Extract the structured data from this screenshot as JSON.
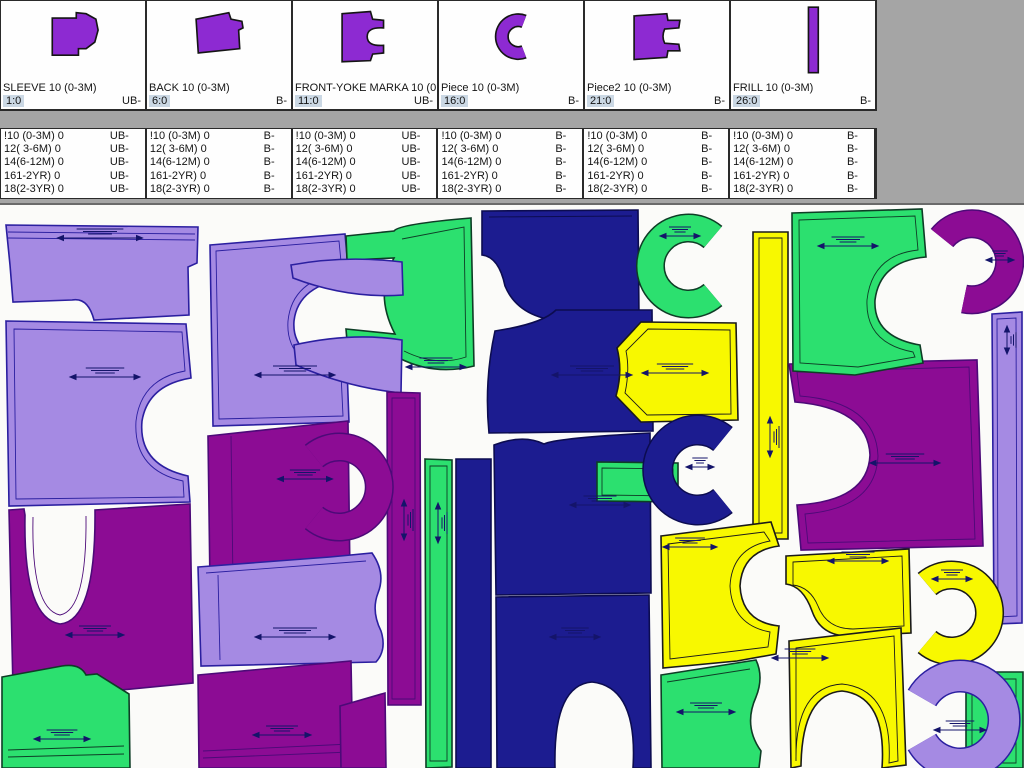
{
  "palette": {
    "lavender": [
      "#a58ae3",
      "#2b1fa0"
    ],
    "purple": [
      "#8c0c94",
      "#4c0a78"
    ],
    "navy": [
      "#1c1c90",
      "#0c0c50"
    ],
    "green": [
      "#2ce06f",
      "#0e3d26"
    ],
    "yellow": [
      "#f8f800",
      "#1a1a1a"
    ],
    "thumb": [
      "#8d2ad2",
      "#151515"
    ],
    "chip_bg": "#cbd8e4",
    "window_bg": "#a5a5a5",
    "marker_bg": "#fbfbf9",
    "annotation": "#14146a"
  },
  "cards": [
    {
      "name": "SLEEVE 10 (0-3M)",
      "index": "1:0",
      "suffix": "UB-",
      "thumb": {
        "d": "M16,12 L38,12 L38,7 L47,8 L56,13 L58,23 L55,34 L47,40 L40,40 L40,46 L16,46 Z"
      }
    },
    {
      "name": "BACK 10 (0-3M)",
      "index": "6:0",
      "suffix": "B-",
      "thumb": {
        "d": "M14,13 L44,7 L46,13 L56,15 L57,21 L53,23 L54,40 L16,44 Z"
      }
    },
    {
      "name": "FRONT-YOKE MARKA 10 (0-3M)",
      "index": "11:0",
      "suffix": "UB-",
      "thumb": {
        "d": "M14,8 L40,6 L42,13 L52,14 L52,21 Q37,20 37,29 Q37,38 52,37 L52,44 L42,45 L40,51 L14,52 Z"
      }
    },
    {
      "name": "Piece 10 (0-3M)",
      "index": "16:0",
      "suffix": "B-",
      "thumb": {
        "type": "arc",
        "d": "M47,15 A15,15 0 1 0 47,43",
        "w": 10
      }
    },
    {
      "name": "Piece2 10 (0-3M)",
      "index": "21:0",
      "suffix": "B-",
      "thumb": {
        "d": "M14,10 L44,8 L45,14 L56,14 L55,21 L42,22 Q39,29 42,35 L55,36 L56,42 L45,42 L44,48 L14,50 Z"
      }
    },
    {
      "name": "FRILL 10 (0-3M)",
      "index": "26:0",
      "suffix": "B-",
      "thumb": {
        "d": "M40,2 L49,2 L49,62 L40,62 Z"
      }
    }
  ],
  "size_lists": [
    {
      "suffix": "UB-",
      "rows": [
        "!10 (0-3M) 0",
        "12( 3-6M) 0",
        "14(6-12M) 0",
        "161-2YR) 0",
        "18(2-3YR) 0"
      ]
    },
    {
      "suffix": "B-",
      "rows": [
        "!10 (0-3M) 0",
        "12( 3-6M) 0",
        "14(6-12M) 0",
        "161-2YR) 0",
        "18(2-3YR) 0"
      ]
    },
    {
      "suffix": "UB-",
      "rows": [
        "!10 (0-3M) 0",
        "12( 3-6M) 0",
        "14(6-12M) 0",
        "161-2YR) 0",
        "18(2-3YR) 0"
      ]
    },
    {
      "suffix": "B-",
      "rows": [
        "!10 (0-3M) 0",
        "12( 3-6M) 0",
        "14(6-12M) 0",
        "161-2YR) 0",
        "18(2-3YR) 0"
      ]
    },
    {
      "suffix": "B-",
      "rows": [
        "!10 (0-3M) 0",
        "12( 3-6M) 0",
        "14(6-12M) 0",
        "161-2YR) 0",
        "18(2-3YR) 0"
      ]
    },
    {
      "suffix": "B-",
      "rows": [
        "!10 (0-3M) 0",
        "12( 3-6M) 0",
        "14(6-12M) 0",
        "161-2YR) 0",
        "18(2-3YR) 0"
      ]
    }
  ],
  "marker": {
    "pieces": [
      {
        "name": "back-yoke",
        "color": "lavender",
        "d": "M6,20 L198,22 L197,58 L188,62 L189,110 L94,115 Q88,92 72,95 L13,97 L10,60 Z",
        "lines": [
          "M8,27 L195,29",
          "M8,33 L195,35"
        ]
      },
      {
        "name": "body-left",
        "color": "lavender",
        "d": "M6,116 L186,119 L191,173 Q148,180 142,216 Q138,260 188,271 L190,297 L9,301 Z",
        "lines": [
          "M14,124 L182,127 L185,166 Q141,174 136,216 Q133,265 183,276 L184,292 L16,294 Z"
        ]
      },
      {
        "name": "body-2",
        "color": "lavender",
        "d": "M210,40 L345,29 L349,73 Q298,80 294,116 Q291,154 347,163 L349,217 L213,221 Z",
        "lines": [
          "M216,46 L339,36 L342,67 Q292,75 288,116 Q285,160 341,169 L343,211 L219,214 Z"
        ]
      },
      {
        "name": "front-straps",
        "color": "green",
        "d": "M346,31 L394,26 Q399,19 471,13 L474,161 Q434,171 399,153 L348,148 L346,124 L395,129 Q374,89 394,53 L347,55 Z",
        "lines": [
          "M402,34 L464,22 L466,152 Q436,162 404,146"
        ]
      },
      {
        "name": "horn-a",
        "color": "lavender",
        "d": "M291,60 Q345,50 402,57 L403,90 Q348,94 293,73 Z"
      },
      {
        "name": "horn-b",
        "color": "lavender",
        "d": "M294,140 Q352,127 402,135 L401,188 Q345,182 296,160 Z"
      },
      {
        "name": "back-top",
        "color": "navy",
        "d": "M482,6 L638,5 L639,113 L560,116 Q518,112 505,81 Q499,52 482,50 Z",
        "lines": [
          "M489,12 L632,11"
        ]
      },
      {
        "name": "back-mid",
        "color": "navy",
        "d": "M495,126 Q542,119 556,105 L652,105 L653,226 L489,228 Q484,176 495,126 Z"
      },
      {
        "name": "body-navy-3",
        "color": "navy",
        "d": "M494,240 Q523,229 544,239 Q556,233 650,228 L651,388 L496,390 Z"
      },
      {
        "name": "body-navy-4",
        "color": "navy",
        "d": "M496,392 L649,390 L651,563 L633,563 Q638,482 592,477 Q553,480 555,563 L497,563 Z"
      },
      {
        "name": "strip-navy",
        "color": "navy",
        "d": "M456,254 L491,254 L491,563 L456,563 Z"
      },
      {
        "name": "strip-green",
        "color": "green",
        "d": "M425,254 L452,255 L452,562 L426,563 Z",
        "lines": [
          "M430,261 L447,261 L447,556 L430,556 Z"
        ]
      },
      {
        "name": "strip-purple",
        "color": "purple",
        "d": "M387,187 L420,188 L421,500 L388,500 Z",
        "lines": [
          "M392,193 L415,193 L415,494 L392,494 Z"
        ]
      },
      {
        "name": "rect-green",
        "color": "green",
        "d": "M597,257 L678,258 L678,297 L597,296 Z",
        "lines": [
          "M602,263 L673,264 L673,291 L602,290 Z"
        ]
      },
      {
        "name": "front-purple",
        "color": "purple",
        "d": "M208,231 L348,216 L350,372 L210,380 Z",
        "lines": [
          "M231,231 L233,377"
        ]
      },
      {
        "name": "c-purple-mid",
        "color": "purple",
        "type": "arc",
        "w": 26,
        "d": "M314,251 A40,40 0 1 1 314,313"
      },
      {
        "name": "sleeve-lavender",
        "color": "lavender",
        "d": "M198,362 L330,352 L372,348 Q386,368 378,388 Q371,406 381,426 Q387,445 376,457 L201,461 Z",
        "lines": [
          "M206,368 L366,356",
          "M218,370 L220,455"
        ]
      },
      {
        "name": "bottom-purple",
        "color": "purple",
        "d": "M198,470 L351,456 L353,563 L199,563 Z",
        "lines": [
          "M203,546 L350,539",
          "M203,553 L350,547"
        ]
      },
      {
        "name": "bottom-purple-2",
        "color": "purple",
        "d": "M340,501 L385,488 L386,563 L341,563 Z"
      },
      {
        "name": "front-u-purple",
        "color": "purple",
        "d": "M9,305 L24,304 L25,310 Q23,413 60,419 Q96,416 95,305 L190,299 L193,478 L100,487 L13,484 Z",
        "lines": [
          "M33,312 Q31,404 60,410 Q87,405 86,311"
        ]
      },
      {
        "name": "green-bottom-left",
        "color": "green",
        "d": "M2,472 L62,461 Q80,458 86,470 L97,469 L129,489 L130,563 L2,563 Z",
        "lines": [
          "M8,545 L124,541",
          "M8,552 L124,549"
        ]
      },
      {
        "name": "c-green-top",
        "color": "green",
        "type": "arc",
        "w": 26,
        "d": "M713,32 A38,38 0 1 0 713,90"
      },
      {
        "name": "yellow-mid",
        "color": "yellow",
        "d": "M641,117 L736,118 L738,215 L641,217 L616,191 Q623,166 617,143 Z",
        "lines": [
          "M648,124 L730,125 L731,209 L647,210 L625,188 Q630,165 626,146 Z"
        ]
      },
      {
        "name": "c-navy",
        "color": "navy",
        "type": "arc",
        "w": 28,
        "d": "M723,234 A40,40 0 1 0 723,296"
      },
      {
        "name": "strip-yellow",
        "color": "yellow",
        "d": "M753,27 L788,27 L788,334 L753,334 Z",
        "lines": [
          "M759,33 L782,33 L782,328 L759,328 Z"
        ]
      },
      {
        "name": "big-purple-right",
        "color": "purple",
        "d": "M789,159 L977,155 L983,341 L801,345 L797,300 Q868,296 870,250 Q868,203 795,197 L792,178 Z",
        "lines": [
          "M797,167 L969,162 L975,334 L808,338 L805,309 Q876,303 878,251 Q876,197 800,191 Z"
        ]
      },
      {
        "name": "front-green-right",
        "color": "green",
        "d": "M792,8 L922,4 L926,52 Q880,56 875,95 Q873,132 920,140 L923,158 L855,170 L793,166 Z",
        "lines": [
          "M799,15 L915,11 L918,45 Q872,50 867,95 Q865,138 913,147 L915,152 L858,162 L800,158 Z"
        ]
      },
      {
        "name": "c-purple-topright",
        "color": "purple",
        "type": "arc",
        "w": 26,
        "d": "M942,33 A38,38 0 1 1 964,94"
      },
      {
        "name": "strip-lavender-right",
        "color": "lavender",
        "d": "M992,109 L1022,107 L1022,418 L994,419 Z",
        "lines": [
          "M997,114 L1016,113 L1017,411 L998,412 Z"
        ]
      },
      {
        "name": "yellow-front-1",
        "color": "yellow",
        "d": "M661,331 L771,317 L779,341 Q742,346 740,381 Q742,417 779,421 L776,449 L737,456 L663,463 Z",
        "lines": [
          "M668,339 L764,327 L770,336 Q732,343 730,381 Q732,420 770,427 L768,442 L670,454 Z"
        ]
      },
      {
        "name": "yellow-piece-2",
        "color": "yellow",
        "d": "M786,351 L909,344 L911,428 L851,431 Q821,432 812,406 Q803,381 786,379 Z",
        "lines": [
          "M793,357 L902,351 L904,421 L853,424 Q827,424 818,401 Q810,382 793,380 Z"
        ]
      },
      {
        "name": "c-yellow",
        "color": "yellow",
        "type": "arc",
        "w": 26,
        "d": "M927,379 A38,38 0 1 1 927,437"
      },
      {
        "name": "yellow-front-2",
        "color": "yellow",
        "d": "M789,436 L901,423 L906,560 L882,563 Q887,491 842,486 Q802,489 801,561 L791,563 Z",
        "lines": [
          "M796,443 L894,431 L898,556 L889,558 Q893,484 842,479 Q795,482 796,556 Z"
        ]
      },
      {
        "name": "green-bottom-mid",
        "color": "green",
        "d": "M661,470 L756,455 Q764,472 756,492 Q743,521 761,546 L759,563 L662,563 Z",
        "lines": [
          "M667,477 L750,464"
        ]
      },
      {
        "name": "green-rect-br",
        "color": "green",
        "d": "M966,467 L1023,467 L1023,563 L966,563 Z",
        "lines": [
          "M972,474 L1016,474 L1016,558 L972,558 Z"
        ]
      },
      {
        "name": "c-lavender-br",
        "color": "lavender",
        "type": "arc",
        "w": 30,
        "d": "M922,493 A44,44 0 1 1 922,537"
      }
    ],
    "annotations": [
      [
        100,
        33,
        85,
        "h"
      ],
      [
        105,
        172,
        70,
        "h"
      ],
      [
        295,
        170,
        80,
        "h"
      ],
      [
        436,
        162,
        60,
        "h"
      ],
      [
        848,
        41,
        60,
        "h"
      ],
      [
        1000,
        55,
        28,
        "h"
      ],
      [
        675,
        168,
        66,
        "h"
      ],
      [
        680,
        31,
        40,
        "h"
      ],
      [
        592,
        170,
        80,
        "h"
      ],
      [
        905,
        258,
        70,
        "h"
      ],
      [
        305,
        274,
        55,
        "h"
      ],
      [
        295,
        432,
        80,
        "h"
      ],
      [
        95,
        430,
        58,
        "h"
      ],
      [
        282,
        530,
        58,
        "h"
      ],
      [
        62,
        534,
        56,
        "h"
      ],
      [
        706,
        507,
        58,
        "h"
      ],
      [
        690,
        342,
        54,
        "h"
      ],
      [
        858,
        356,
        60,
        "h"
      ],
      [
        800,
        453,
        56,
        "h"
      ],
      [
        960,
        525,
        52,
        "h"
      ],
      [
        404,
        315,
        40,
        "v"
      ],
      [
        438,
        318,
        40,
        "v"
      ],
      [
        770,
        232,
        40,
        "v"
      ],
      [
        1007,
        135,
        28,
        "v"
      ],
      [
        600,
        300,
        60,
        "h"
      ],
      [
        700,
        262,
        28,
        "h"
      ],
      [
        952,
        374,
        40,
        "h"
      ],
      [
        575,
        432,
        50,
        "h"
      ]
    ]
  }
}
